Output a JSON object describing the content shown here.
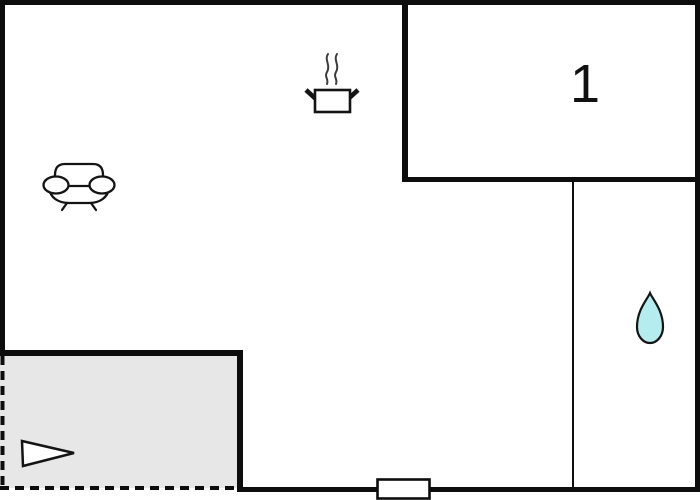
{
  "colors": {
    "wall": "#0d0d0d",
    "terrace_fill": "#e7e7e7",
    "water_drop_fill": "#b5eced",
    "steam": "#3c3c3c",
    "background": "#ffffff"
  },
  "floor_plan": {
    "room_label": "1",
    "icons": [
      "sofa-icon",
      "cooking-pot-icon",
      "water-drop-icon",
      "direction-arrow-icon",
      "door-marker"
    ]
  }
}
